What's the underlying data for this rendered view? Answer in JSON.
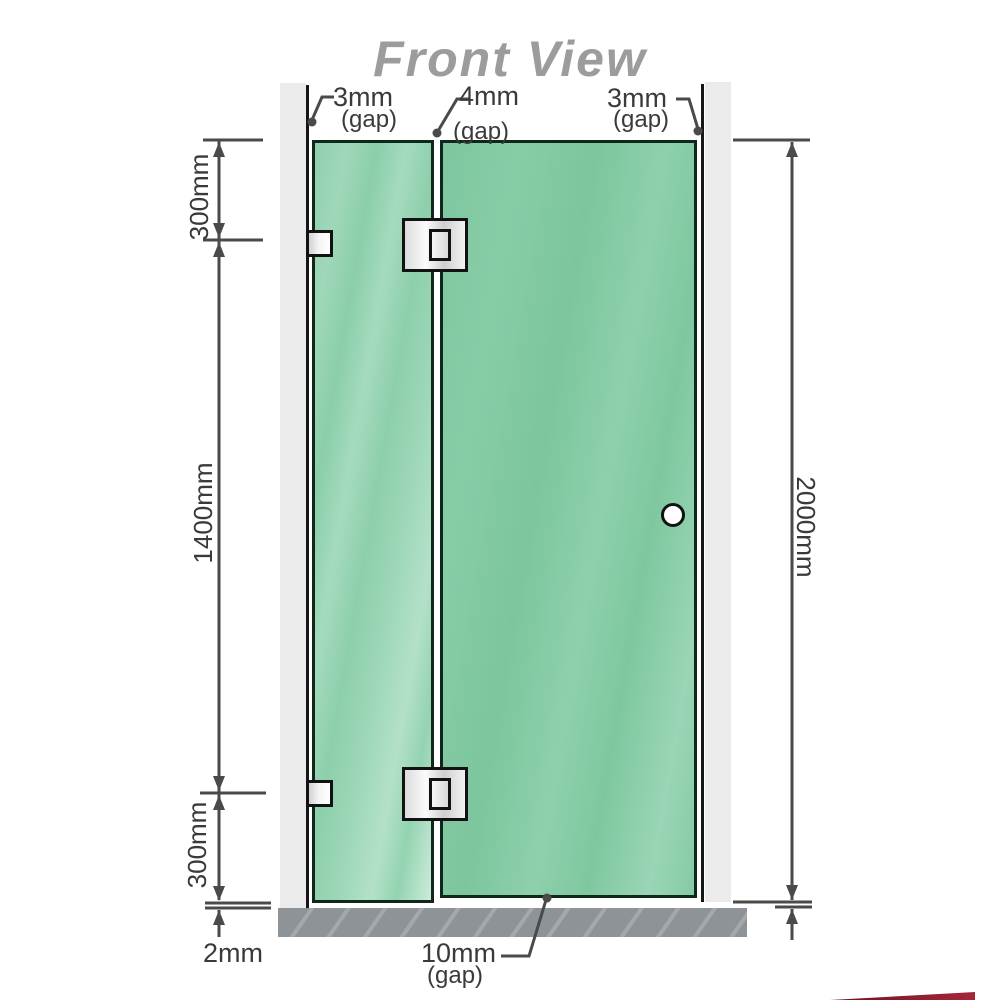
{
  "title": "Front View",
  "gap_labels": {
    "top_left": {
      "value": "3mm",
      "note": "(gap)"
    },
    "top_middle": {
      "value": "4mm",
      "note": "(gap)"
    },
    "top_right": {
      "value": "3mm",
      "note": "(gap)"
    },
    "bottom": {
      "value": "10mm",
      "note": "(gap)"
    }
  },
  "dimensions": {
    "left_top": "300mm",
    "left_middle": "1400mm",
    "left_bottom": "300mm",
    "floor_gap": "2mm",
    "overall_height": "2000mm"
  },
  "parts": {
    "fixed_panel": "glass-fixed-panel",
    "door_panel": "glass-door-panel",
    "hinges": "glass-to-glass-hinge",
    "brackets": "wall-to-glass-bracket",
    "handle": "door-handle-knob"
  },
  "colors": {
    "glass": "#84caa4",
    "glass_highlight": "#cdebdc",
    "wall": "#ebebeb",
    "floor": "#8e9397",
    "outline": "#121212",
    "dimension_line": "#4a4a4a",
    "label_text": "#3a3a3a",
    "title_text": "#9c9c9c",
    "hardware": "#e6e6e6",
    "logo_accent": "#8b1d2e"
  }
}
